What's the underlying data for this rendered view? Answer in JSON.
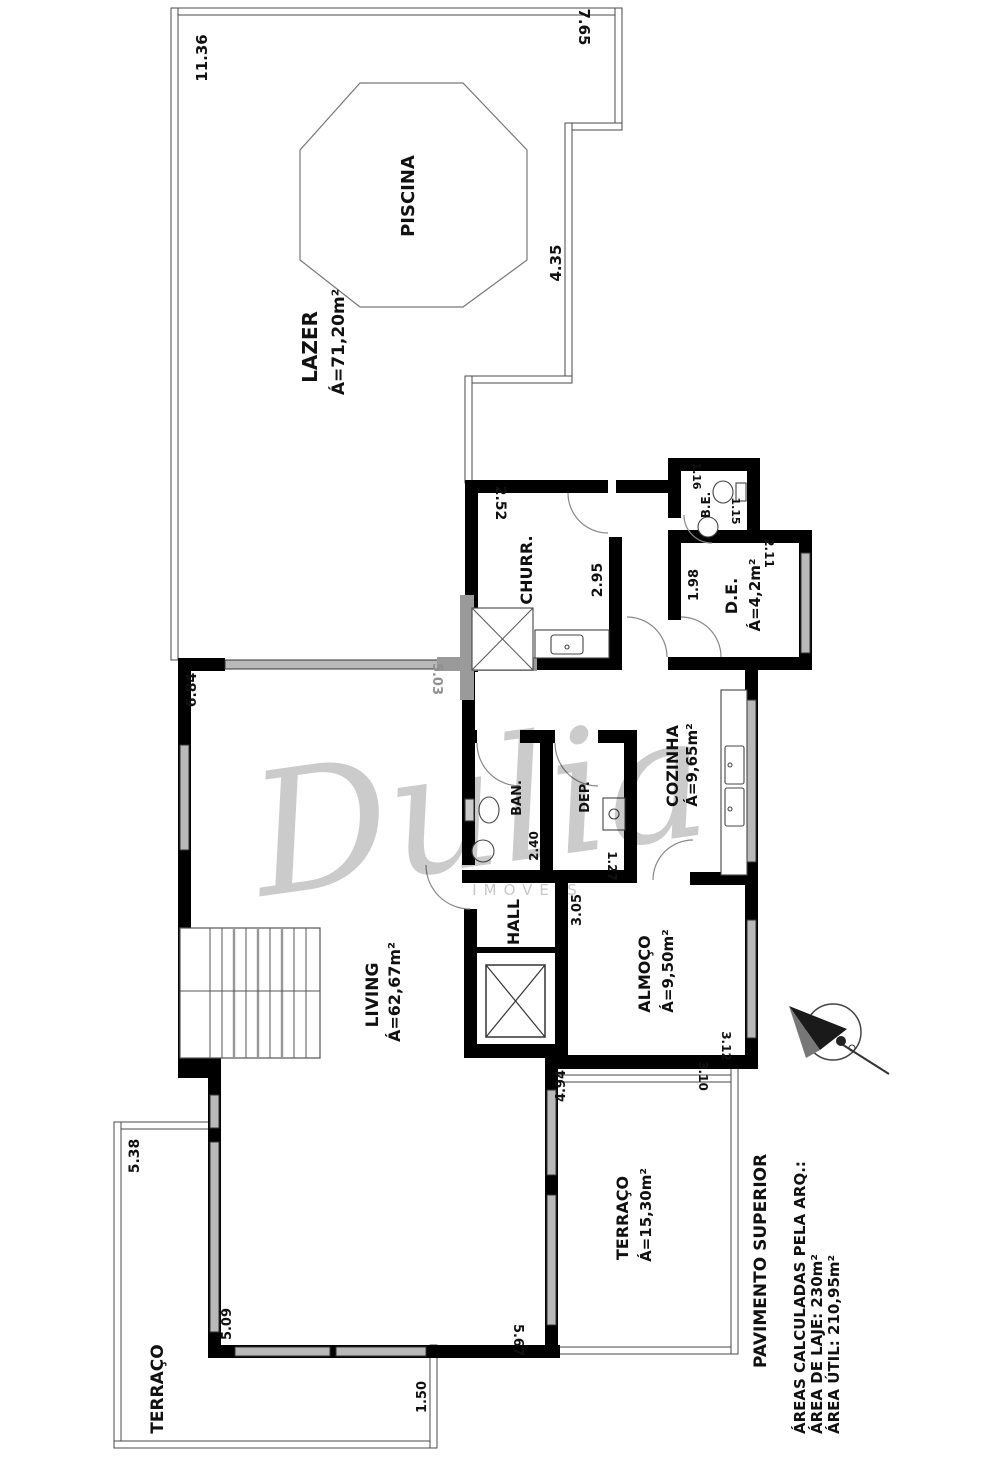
{
  "plan_title": "PAVIMENTO SUPERIOR",
  "watermark": {
    "script": "Dulia",
    "subtext": "IMÓVEIS"
  },
  "rooms": {
    "piscina": {
      "label": "PISCINA"
    },
    "lazer": {
      "label": "LAZER",
      "area": "Á=71,20m²"
    },
    "churrasqueira": {
      "label": "CHURR."
    },
    "be": {
      "label": "B.E."
    },
    "de": {
      "label": "D.E.",
      "area": "Á=4,2m²"
    },
    "cozinha": {
      "label": "COZINHA",
      "area": "Á=9,65m²"
    },
    "banheiro": {
      "label": "BAN."
    },
    "deposito": {
      "label": "DEP."
    },
    "hall": {
      "label": "HALL"
    },
    "living": {
      "label": "LIVING",
      "area": "Á=62,67m²"
    },
    "almoco": {
      "label": "ALMOÇO",
      "area": "Á=9,50m²"
    },
    "terraco_direito": {
      "label": "TERRAÇO",
      "area": "Á=15,30m²"
    },
    "terraco_esquerdo": {
      "label": "TERRAÇO"
    }
  },
  "dims": {
    "lazer_esquerda": "11.36",
    "lazer_topo": "7.65",
    "lazer_direita": "4.35",
    "churr_topo": "2.52",
    "churr_direita": "2.95",
    "be_topo": "1.16",
    "be_direita": "1.15",
    "de_esquerda": "1.98",
    "de_topo": "2.11",
    "eixo_living": "5.03",
    "living_esquerda": "6.84",
    "ban_direita": "2.40",
    "dep_baixo": "1.27",
    "almoco_topo": "3.05",
    "almoco_baixo": "3.12",
    "terraco_dir_topo": "3.10",
    "living_ext_direita": "4.94",
    "terraco_esq_esquerda": "5.38",
    "living_ext_esquerda": "5.09",
    "living_baixo": "5.67",
    "terraco_esq_direita": "1.50"
  },
  "footer": {
    "titulo": "PAVIMENTO SUPERIOR",
    "linha1": "ÁREAS CALCULADAS PELA ARQ.:",
    "linha2": "ÁREA DE LAJE: 230m²",
    "linha3": "ÁREA ÚTIL: 210,95m²"
  },
  "colors": {
    "wall": "#000000",
    "window": "#b9b9b9",
    "axis_gray": "#9a9a9a",
    "dim_axis_text": "#8f8f8f",
    "background": "#ffffff"
  }
}
